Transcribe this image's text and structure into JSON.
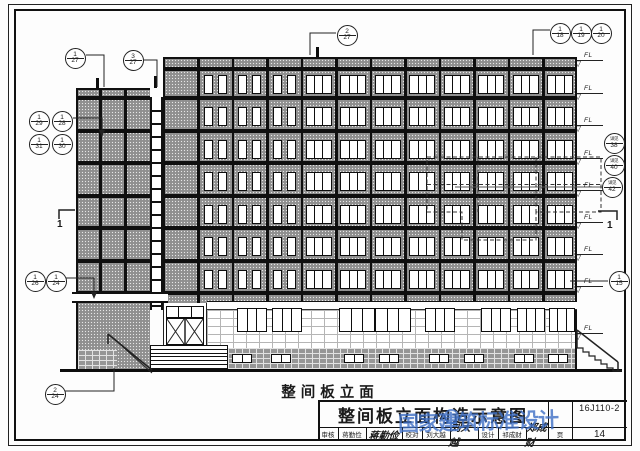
{
  "sheet": {
    "caption": "整间板立面",
    "title": "整间板立面构造示意图",
    "atlas_no": "16J110-2",
    "page_label": "页",
    "page_no": "14",
    "review_label": "审核",
    "review_name": "蒋勤俭",
    "review_sig": "蒋勤俭",
    "check_label": "校对",
    "check_name": "刘大越",
    "check_sig": "刘大越",
    "design_label": "设计",
    "design_name": "祁成财",
    "design_sig": "郑成财",
    "watermark": "国家建筑标准设计"
  },
  "markers": {
    "level_label": "FL",
    "section_label": "1",
    "detail_bubbles": [
      {
        "top": "1",
        "bottom": "27",
        "x": 75,
        "y": 58
      },
      {
        "top": "3",
        "bottom": "27",
        "x": 133,
        "y": 60
      },
      {
        "top": "2",
        "bottom": "27",
        "x": 347,
        "y": 35
      },
      {
        "top": "1",
        "bottom": "18",
        "x": 560,
        "y": 33
      },
      {
        "top": "1",
        "bottom": "19",
        "x": 581,
        "y": 33
      },
      {
        "top": "1",
        "bottom": "20",
        "x": 601,
        "y": 33
      },
      {
        "top": "1",
        "bottom": "29",
        "x": 39,
        "y": 121
      },
      {
        "top": "1",
        "bottom": "28",
        "x": 62,
        "y": 121
      },
      {
        "top": "1",
        "bottom": "31",
        "x": 39,
        "y": 144
      },
      {
        "top": "1",
        "bottom": "30",
        "x": 62,
        "y": 144
      },
      {
        "top": "1",
        "bottom": "26",
        "x": 35,
        "y": 281
      },
      {
        "top": "1",
        "bottom": "24",
        "x": 56,
        "y": 281
      },
      {
        "top": "2",
        "bottom": "24",
        "x": 55,
        "y": 394
      },
      {
        "top": "1",
        "bottom": "15",
        "x": 619,
        "y": 281
      },
      {
        "top": "详见",
        "bottom": "38",
        "x": 614,
        "y": 143,
        "tiny": true
      },
      {
        "top": "详见",
        "bottom": "40",
        "x": 614,
        "y": 165,
        "tiny": true
      },
      {
        "top": "详见",
        "bottom": "42",
        "x": 612,
        "y": 187,
        "tiny": true
      }
    ],
    "level_ys": [
      60,
      93,
      125,
      158,
      190,
      222,
      254,
      286,
      333
    ]
  },
  "colors": {
    "ink": "#1a1a1a",
    "watermark_blue": "#3e6fc6",
    "panel_gray": "#8f8f8f"
  }
}
